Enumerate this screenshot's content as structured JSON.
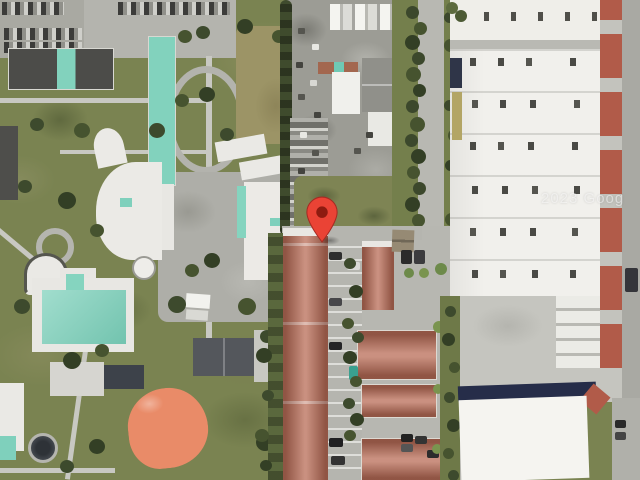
{
  "map": {
    "view": "satellite",
    "provider_watermark": "2023 Goog",
    "marker": {
      "name": "location-pin",
      "pin_color": "#EA4335",
      "pin_inner_color": "#8E1B10"
    },
    "palette": {
      "grass": "#7A8351",
      "tan_field": "#9C9466",
      "road": "#B8B8B2",
      "concrete": "#C5C5BF",
      "dark_roof": "#4C4C49",
      "teal_roof": "#82D2BD",
      "townhouse_roof": "#BE7864",
      "infield_clay": "#E98B68",
      "warehouse_roof": "#F1F0EC",
      "loading_dock_red": "#B15B49",
      "navy_roof": "#262D49",
      "tree_green": "#3D4A2D",
      "court_dark": "#3D424A",
      "pool_teal": "#7FD0BC"
    }
  }
}
